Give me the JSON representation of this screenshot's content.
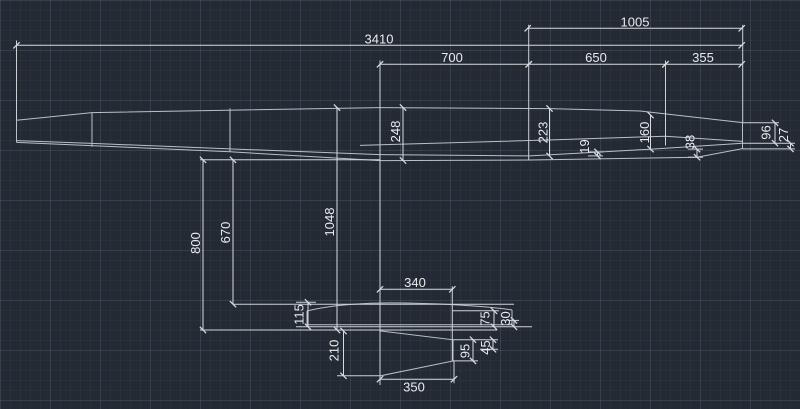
{
  "canvas": {
    "background_color": "#232a33",
    "line_color": "#c9ced4",
    "text_color": "#e9ebee",
    "description": "CAD model-space drawing of a glider plan with dimensions"
  },
  "dims": {
    "d3410": "3410",
    "d1005": "1005",
    "d700": "700",
    "d650": "650",
    "d355": "355",
    "d248": "248",
    "d223": "223",
    "d19": "19",
    "d160": "160",
    "d38": "38",
    "d96": "96",
    "d27": "27",
    "d800": "800",
    "d670": "670",
    "d1048": "1048",
    "d340": "340",
    "d115": "115",
    "d75": "75",
    "d30": "30",
    "d210": "210",
    "d95": "95",
    "d45": "45",
    "d350": "350"
  }
}
